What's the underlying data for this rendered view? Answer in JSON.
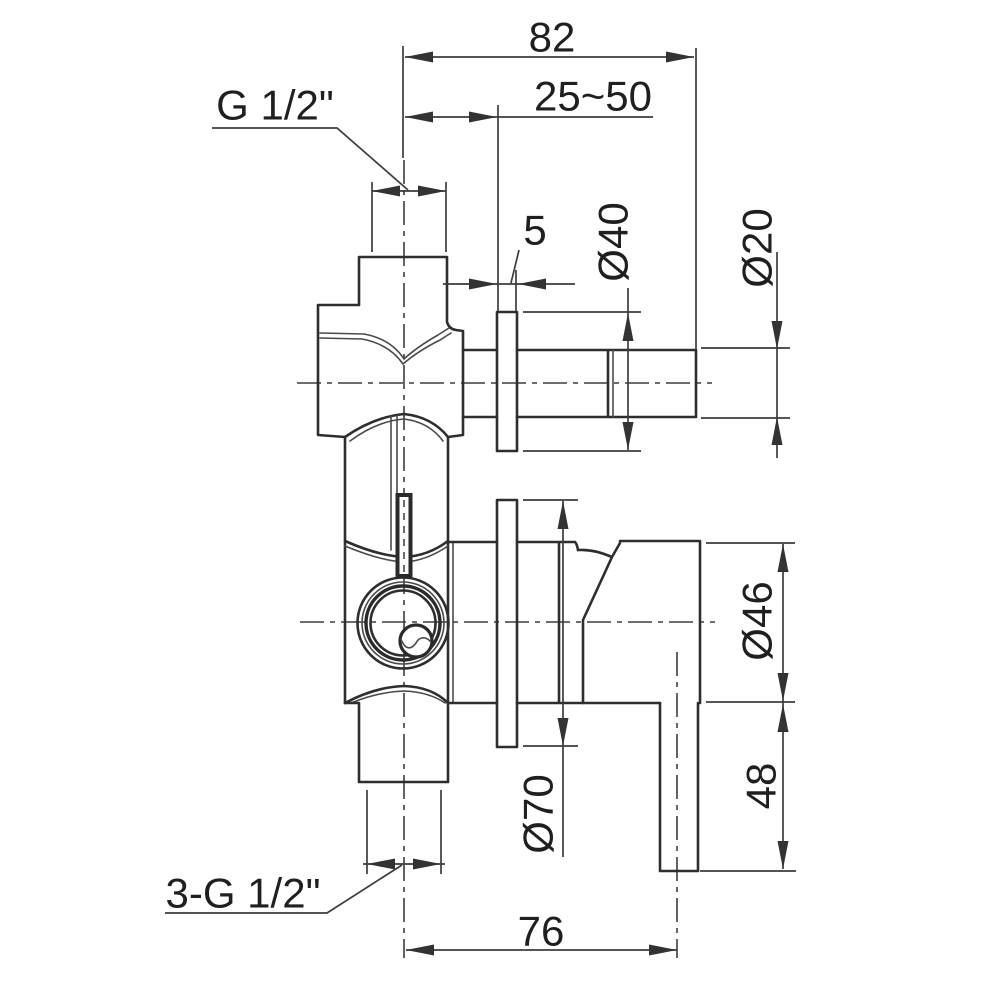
{
  "page": {
    "background": "#ffffff",
    "line_color": "#2e2e2e",
    "dimension_line_color": "#3d3d3d",
    "text_color": "#1f1f1f"
  },
  "drawing": {
    "labels": {
      "overall_width": "82",
      "wall_depth_range": "25~50",
      "top_thread": "G 1/2\"",
      "escutcheon_thickness": "5",
      "escutcheon_diameter": "Ø40",
      "outlet_pipe_diameter": "Ø20",
      "rosette_diameter": "Ø70",
      "handle_diameter": "Ø46",
      "lever_length": "48",
      "bottom_threads": "3-G 1/2\"",
      "lever_offset": "76"
    }
  }
}
